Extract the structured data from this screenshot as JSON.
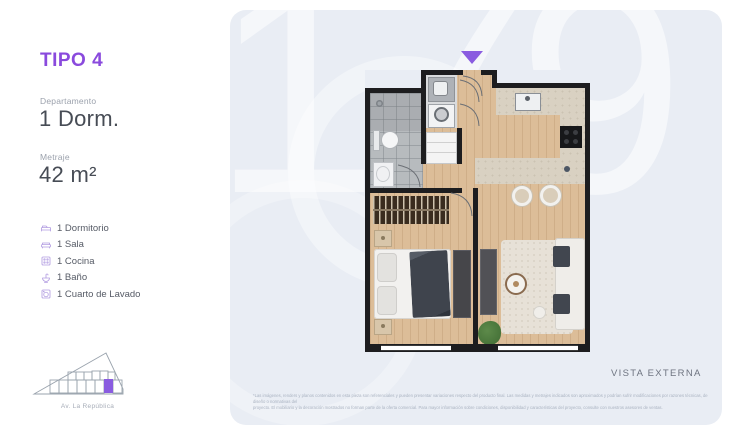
{
  "panel": {
    "tipo": "TIPO 4",
    "departamento_label": "Departamento",
    "departamento_value": "1 Dorm.",
    "metraje_label": "Metraje",
    "metraje_value": "42 m²",
    "features": [
      {
        "icon": "bed-icon",
        "label": "1 Dormitorio"
      },
      {
        "icon": "sofa-icon",
        "label": "1 Sala"
      },
      {
        "icon": "stove-icon",
        "label": "1 Cocina"
      },
      {
        "icon": "sink-icon",
        "label": "1 Baño"
      },
      {
        "icon": "washer-icon",
        "label": "1 Cuarto de Lavado"
      }
    ],
    "map_street": "Av. La República"
  },
  "plan_card": {
    "watermark": "179",
    "vista_label": "VISTA EXTERNA",
    "disclaimer_line1": "*Las imágenes, renders y planos contenidos en esta pieza son referenciales y pueden presentar variaciones respecto del producto final. Las medidas y metrajes indicados son aproximados y podrían sufrir modificaciones por razones técnicas, de diseño o normativas del",
    "disclaimer_line2": "proyecto. El mobiliario y la decoración mostrados no forman parte de la oferta comercial. Para mayor información sobre condiciones, disponibilidad y características del proyecto, consulte con nuestros asesores de ventas."
  },
  "colors": {
    "accent_purple": "#8A4ADD",
    "icon_purple": "#B49FE2",
    "card_bg": "#E9EDF4",
    "wall_black": "#1D1D1F",
    "wood_floor": "#DCBD98"
  }
}
